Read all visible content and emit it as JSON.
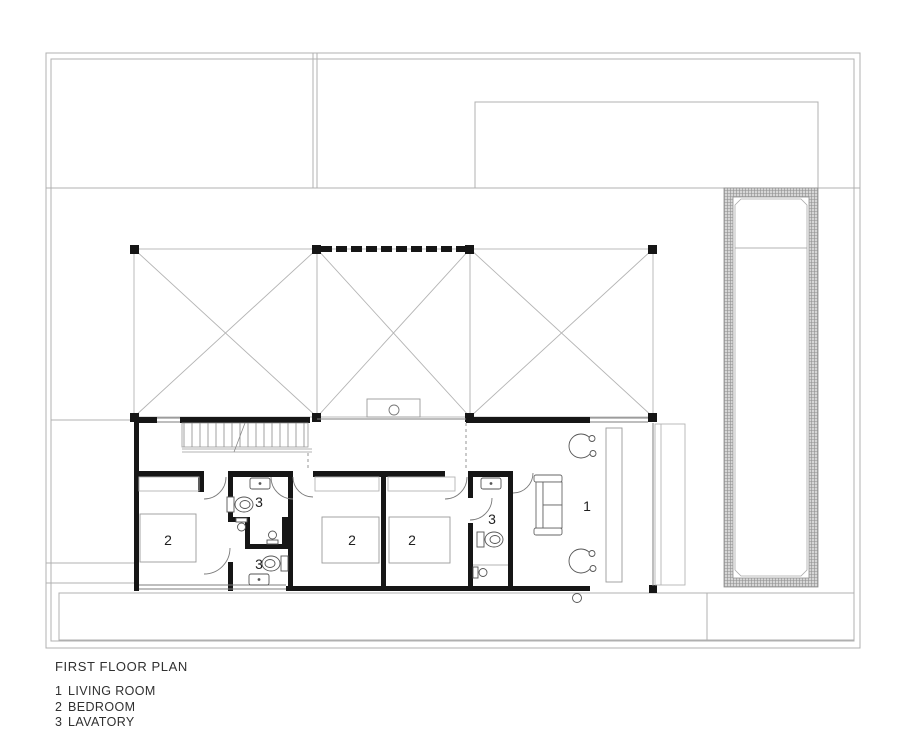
{
  "drawing": {
    "title": "FIRST FLOOR PLAN",
    "legend": [
      {
        "number": "1",
        "label": "LIVING ROOM"
      },
      {
        "number": "2",
        "label": "BEDROOM"
      },
      {
        "number": "3",
        "label": "LAVATORY"
      }
    ],
    "room_labels": [
      {
        "room": "bedroom-left",
        "text": "2"
      },
      {
        "room": "bedroom-middle",
        "text": "2"
      },
      {
        "room": "bedroom-right",
        "text": "2"
      },
      {
        "room": "lavatory-upper",
        "text": "3"
      },
      {
        "room": "lavatory-lower",
        "text": "3"
      },
      {
        "room": "lavatory-east",
        "text": "3"
      },
      {
        "room": "living-room",
        "text": "1"
      }
    ],
    "colors": {
      "wall": "#161616",
      "thin_line": "#9a9a9a",
      "site_line": "#b0b0b0",
      "medium_line": "#666666",
      "pool_hatch": "#8f8f8f",
      "pool_fill": "#d6d6d6",
      "text": "#303030"
    }
  }
}
